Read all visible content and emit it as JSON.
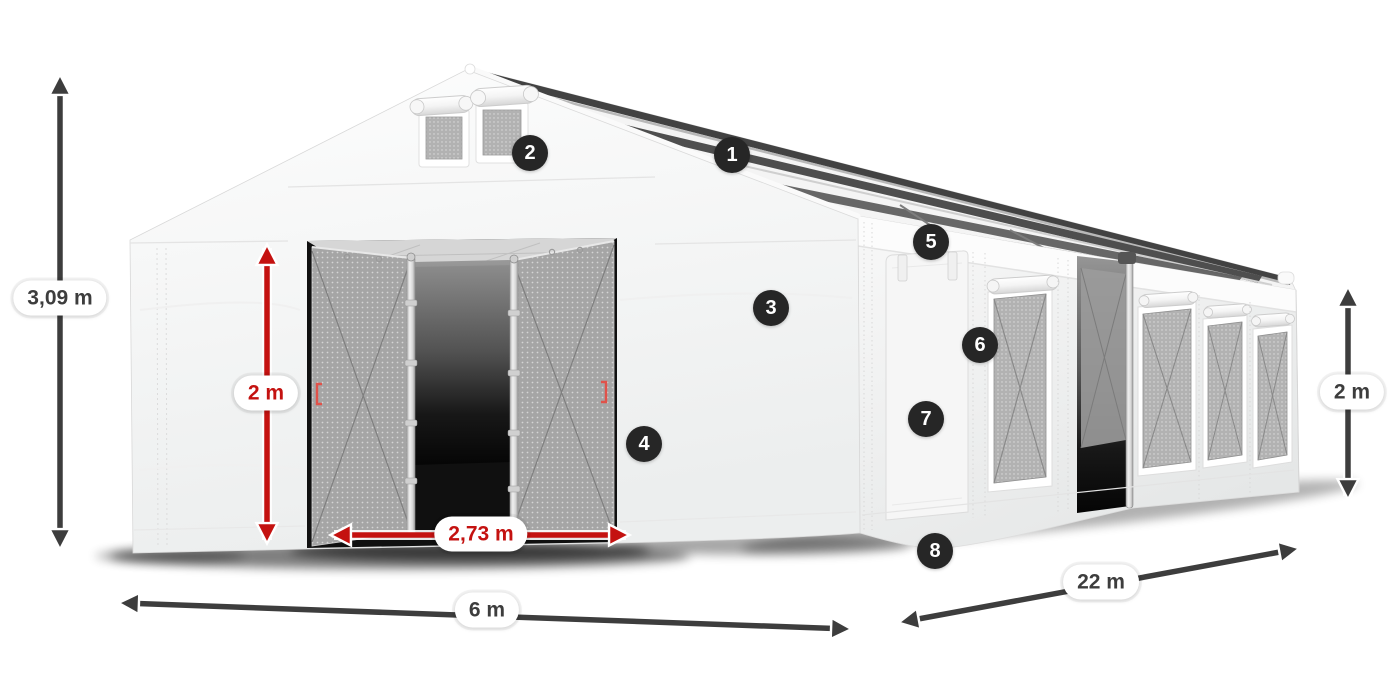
{
  "diagram": {
    "type": "product-dimension-diagram",
    "subject": "marquee-tent",
    "dimensions": {
      "total_height": {
        "label": "3,09 m",
        "color": "#3d3d3d"
      },
      "entrance_height": {
        "label": "2 m",
        "color": "#c41210"
      },
      "entrance_width": {
        "label": "2,73 m",
        "color": "#c41210"
      },
      "front_width": {
        "label": "6 m",
        "color": "#3d3d3d"
      },
      "side_length": {
        "label": "22 m",
        "color": "#3d3d3d"
      },
      "side_wall_height": {
        "label": "2 m",
        "color": "#3d3d3d"
      }
    },
    "hotspots": [
      {
        "number": "1"
      },
      {
        "number": "2"
      },
      {
        "number": "3"
      },
      {
        "number": "4"
      },
      {
        "number": "5"
      },
      {
        "number": "6"
      },
      {
        "number": "7"
      },
      {
        "number": "8"
      }
    ],
    "colors": {
      "background": "#ffffff",
      "arrow_dark": "#3d3d3d",
      "arrow_red": "#c41210",
      "hotspot_background": "#262626",
      "hotspot_text": "#ffffff",
      "label_background": "#ffffff",
      "mesh_gray": "#a5a5a5"
    }
  }
}
